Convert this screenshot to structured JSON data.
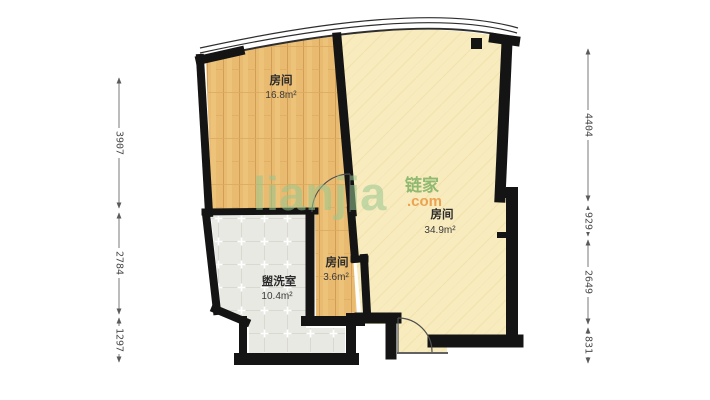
{
  "watermark": {
    "brand": "lianjia",
    "brand_cn": "链家",
    "domain_suffix": ".com"
  },
  "rooms": {
    "bedroom_left": {
      "label": "房间",
      "area": "16.8",
      "unit": "m²"
    },
    "bedroom_right": {
      "label": "房间",
      "area": "34.9",
      "unit": "m²"
    },
    "hall_small": {
      "label": "房间",
      "area": "3.6",
      "unit": "m²"
    },
    "washroom": {
      "label": "盥洗室",
      "area": "10.4",
      "unit": "m²"
    }
  },
  "dimensions_left": [
    {
      "value": "3907"
    },
    {
      "value": "2784"
    },
    {
      "value": "1297"
    }
  ],
  "dimensions_right": [
    {
      "value": "4404"
    },
    {
      "value": "929"
    },
    {
      "value": "2649"
    },
    {
      "value": "831"
    }
  ],
  "colors": {
    "wall": "#141414",
    "wood_floor": "#e9bb71",
    "plain_floor": "#f8ebbe",
    "tile_floor": "#e9e9e4",
    "watermark_green": "#96c68e",
    "watermark_cn_green": "#76ad5e",
    "watermark_orange": "#e9963e",
    "dimension_text": "#4a4a4a"
  }
}
